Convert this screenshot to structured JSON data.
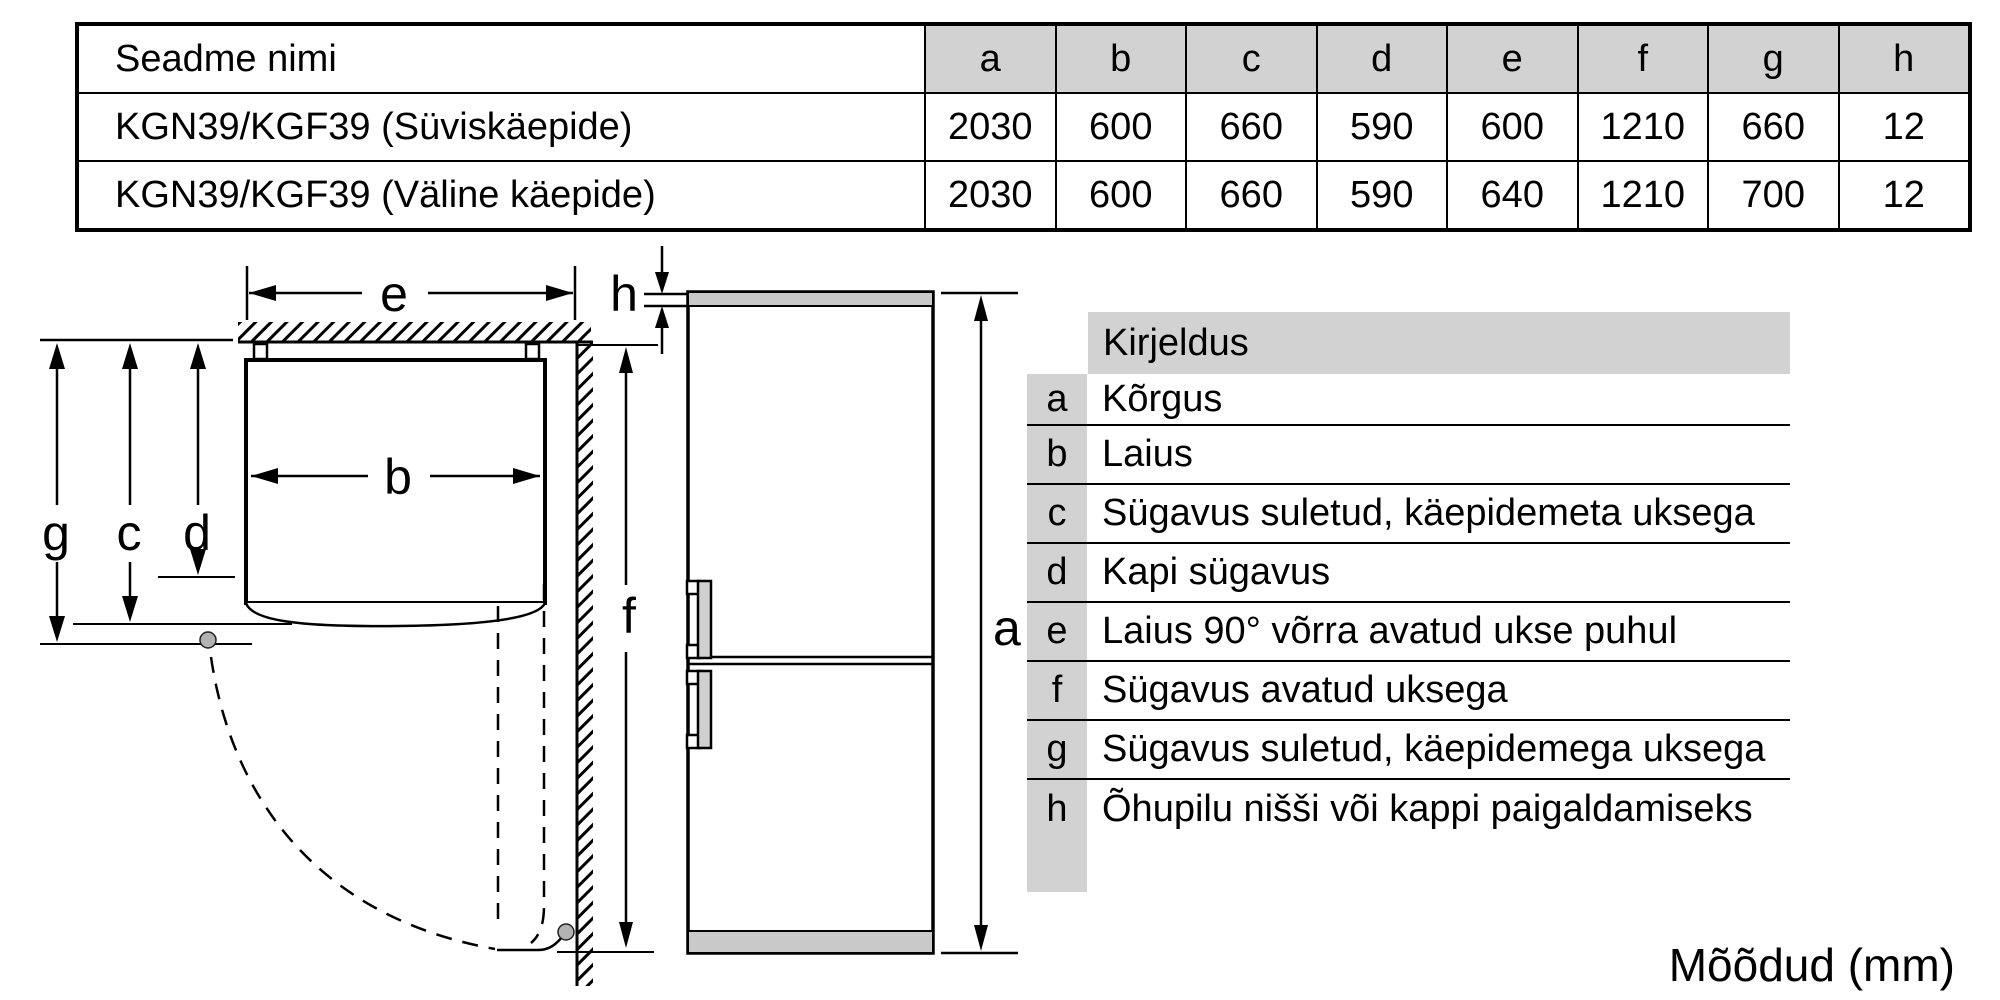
{
  "table": {
    "name_header": "Seadme nimi",
    "dim_headers": [
      "a",
      "b",
      "c",
      "d",
      "e",
      "f",
      "g",
      "h"
    ],
    "rows": [
      {
        "name": "KGN39/KGF39 (Süviskäepide)",
        "values": [
          "2030",
          "600",
          "660",
          "590",
          "600",
          "1210",
          "660",
          "12"
        ]
      },
      {
        "name": "KGN39/KGF39 (Väline käepide)",
        "values": [
          "2030",
          "600",
          "660",
          "590",
          "640",
          "1210",
          "700",
          "12"
        ]
      }
    ]
  },
  "legend": {
    "header": "Kirjeldus",
    "rows": [
      {
        "key": "a",
        "text": "Kõrgus"
      },
      {
        "key": "b",
        "text": "Laius"
      },
      {
        "key": "c",
        "text": "Sügavus suletud, käepidemeta uksega"
      },
      {
        "key": "d",
        "text": "Kapi sügavus"
      },
      {
        "key": "e",
        "text": "Laius 90° võrra avatud ukse puhul"
      },
      {
        "key": "f",
        "text": "Sügavus avatud uksega"
      },
      {
        "key": "g",
        "text": "Sügavus suletud, käepidemega uksega"
      },
      {
        "key": "h",
        "text": "Õhupilu nišši või kappi paigaldamiseks"
      }
    ]
  },
  "diagram": {
    "labels": {
      "a": "a",
      "b": "b",
      "c": "c",
      "d": "d",
      "e": "e",
      "f": "f",
      "g": "g",
      "h": "h"
    }
  },
  "footer": {
    "units_label": "Mõõdud (mm)"
  },
  "colors": {
    "table_header_gray": "#d2d2d2",
    "band_gray": "#c9c9c9",
    "dot_gray": "#b3b3b3"
  }
}
